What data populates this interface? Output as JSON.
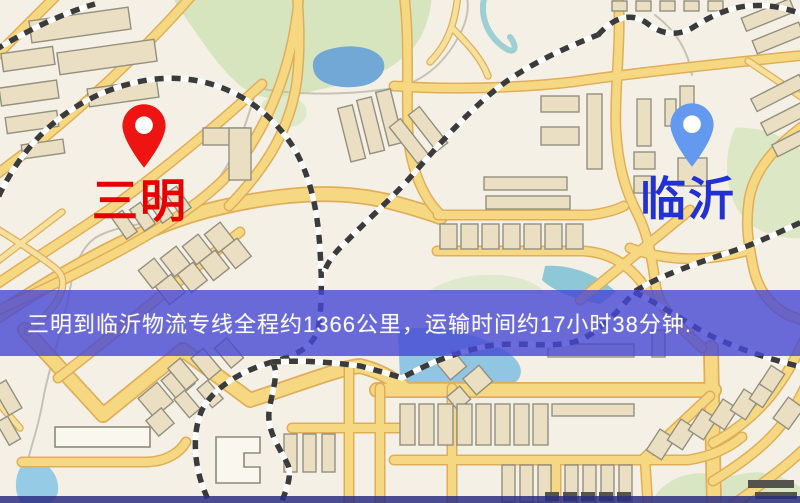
{
  "map": {
    "markers": [
      {
        "id": "origin",
        "label": "三明",
        "pin_icon": "map-pin-icon",
        "pin_color": "#ee1411",
        "label_color": "#e60000"
      },
      {
        "id": "destination",
        "label": "临沂",
        "pin_icon": "map-pin-icon",
        "pin_color": "#6499f0",
        "label_color": "#2231d4"
      }
    ],
    "banner": {
      "text": "三明到临沂物流专线全程约1366公里，运输时间约17小时38分钟.",
      "background": "#4647d5",
      "opacity": 0.8,
      "text_color": "#ffffff"
    },
    "palette": {
      "background": "#f5f0e5",
      "road_fill": "#f8d87e",
      "road_casing": "#e2ae55",
      "park_green": "#d6e5bd",
      "water_blue": "#79b9e2",
      "railway_dark": "#3b3b3b",
      "building_beige": "#eadfc2"
    }
  }
}
